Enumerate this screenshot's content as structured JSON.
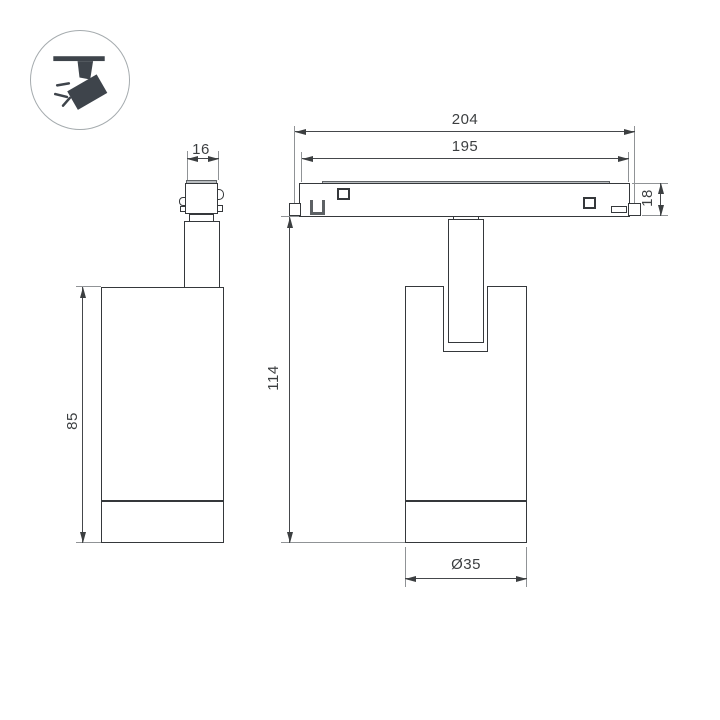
{
  "drawing": {
    "kind": "technical-dimension-drawing",
    "subject": "magnetic track spotlight, two orthographic views",
    "background": "#ffffff"
  },
  "icon_badge": {
    "name": "track-spotlight-icon",
    "color": "#3e444b",
    "circle_border": "#a5abae"
  },
  "dims": {
    "adapter_width": "16",
    "body_height": "85",
    "track_length_outer": "204",
    "track_length_inner": "195",
    "track_height": "18",
    "fixture_height": "114",
    "body_diameter": "Ø35"
  },
  "colors": {
    "outline": "#35383b",
    "dimension_line": "#45484b",
    "extension_line": "#909396",
    "gray_fill": "#b9bdc0"
  }
}
